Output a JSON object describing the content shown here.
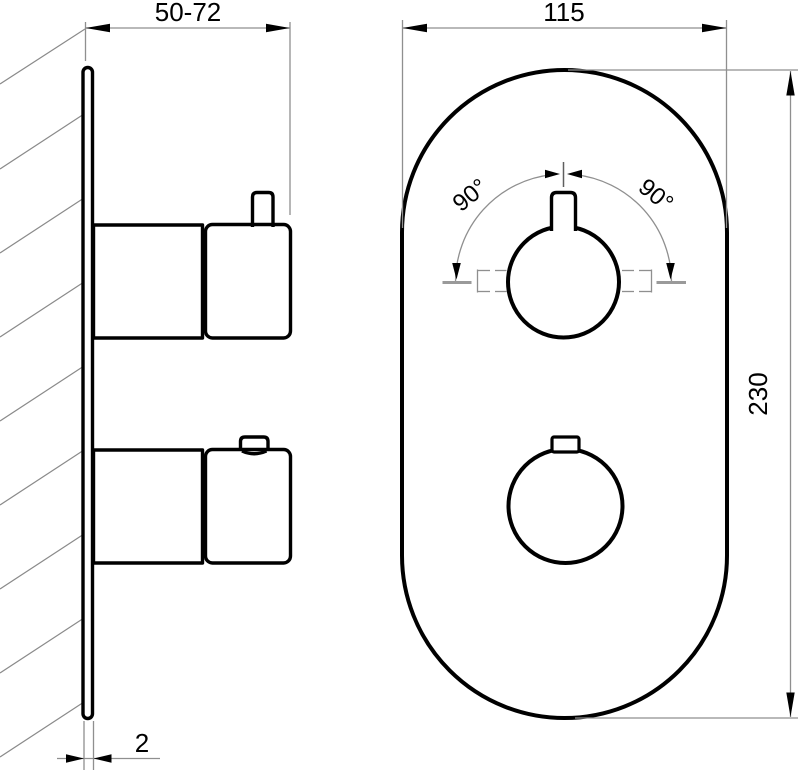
{
  "colors": {
    "object_line": "#000000",
    "thin_line": "#8f8f8f",
    "background": "#ffffff"
  },
  "views": {
    "side": {
      "dimensions": {
        "wall_to_front": {
          "label": "50-72"
        },
        "plate_thickness": {
          "label": "2"
        }
      }
    },
    "front": {
      "dimensions": {
        "plate_width": {
          "label": "115"
        },
        "plate_height": {
          "label": "230"
        },
        "handle_rotation_left": {
          "label": "90°"
        },
        "handle_rotation_right": {
          "label": "90°"
        }
      }
    }
  }
}
